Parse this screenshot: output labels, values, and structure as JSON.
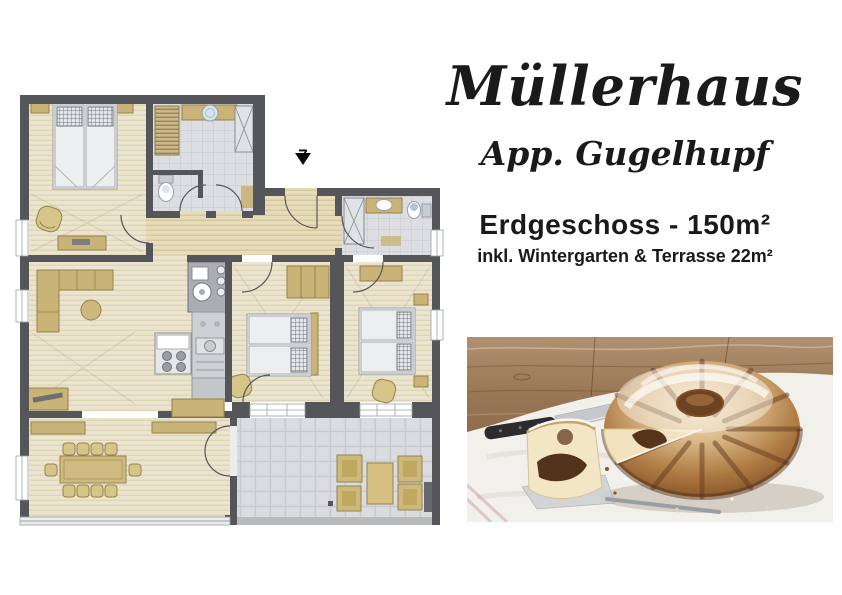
{
  "header": {
    "title": "Müllerhaus",
    "subtitle": "App. Gugelhupf"
  },
  "details": {
    "floor_label": "Erdgeschoss - 150m²",
    "included_label": "inkl. Wintergarten & Terrasse 22m²"
  },
  "floorplan": {
    "entrance_label": "7",
    "colors": {
      "wall": "#55565a",
      "wood_floor": "#ebe5d0",
      "corridor_floor": "#e7dcba",
      "tile_floor": "#dcdee1",
      "terrace_tile": "#d4d6d9",
      "furniture_tan": "#c9b377",
      "furniture_tan_dark": "#94824e",
      "mattress": "#eceef0",
      "glass_front": "#eceded"
    }
  },
  "photo": {
    "semantic": "marble-gugelhupf-cake-photo",
    "colors": {
      "wood_table": "#a07c58",
      "tablecloth": "#f2f0eb",
      "cake_crust": "#7c4a24",
      "cake_crumb": "#f2e2bd",
      "chocolate": "#553419"
    }
  }
}
